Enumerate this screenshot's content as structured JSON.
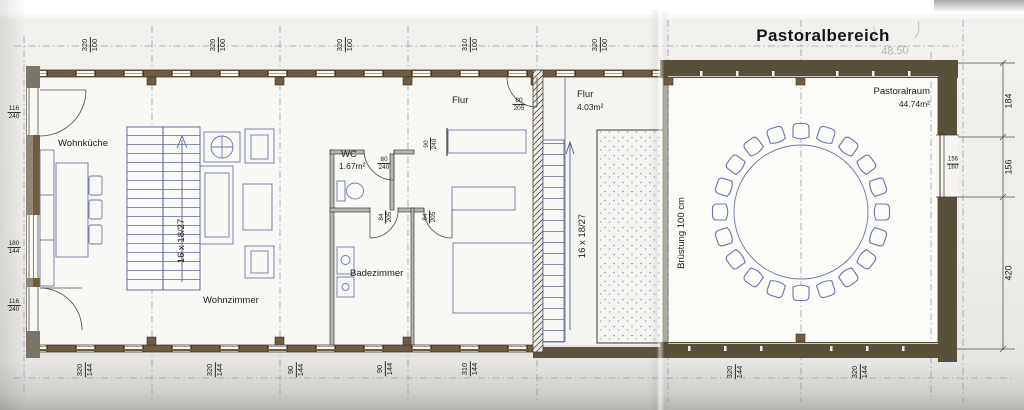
{
  "title": "Pastoralbereich",
  "faint_mark": "48.50",
  "rooms": {
    "wohnkueche": "Wohnküche",
    "wohnzimmer": "Wohnzimmer",
    "wc_name": "WC",
    "wc_area": "1.67m²",
    "badezimmer": "Badezimmer",
    "flur_small": "Flur",
    "flur_main": "Flur",
    "flur_main_area": "4.03m²",
    "pastoralraum_name": "Pastoralraum",
    "pastoralraum_area": "44.74m²"
  },
  "annotations": {
    "stair_left": "16 x 18/27",
    "stair_right": "16 x 18/27",
    "parapet": "Brüstung 100 cm"
  },
  "openings": {
    "wc_door": {
      "num": "80",
      "den": "240"
    },
    "flur_door": {
      "num": "80",
      "den": "205"
    },
    "bad_door": {
      "num": "84",
      "den": "205"
    },
    "room_door": {
      "num": "84",
      "den": "205"
    },
    "mid_window": {
      "num": "90",
      "den": "240"
    },
    "right_window": {
      "num": "156",
      "den": "160"
    }
  },
  "dims_top": [
    {
      "num": "320",
      "den": "100"
    },
    {
      "num": "320",
      "den": "100"
    },
    {
      "num": "320",
      "den": "100"
    },
    {
      "num": "310",
      "den": "100"
    },
    {
      "num": "320",
      "den": "100"
    }
  ],
  "dims_bottom": [
    {
      "num": "320",
      "den": "144"
    },
    {
      "num": "320",
      "den": "144"
    },
    {
      "num": "90",
      "den": "144"
    },
    {
      "num": "90",
      "den": "144"
    },
    {
      "num": "310",
      "den": "144"
    },
    {
      "num": "320",
      "den": "144"
    },
    {
      "num": "320",
      "den": "144"
    }
  ],
  "dims_left": [
    {
      "num": "116",
      "den": "240"
    },
    {
      "num": "180",
      "den": "144"
    },
    {
      "num": "116",
      "den": "240"
    }
  ],
  "dims_right": [
    "184",
    "156",
    "420"
  ],
  "colors": {
    "wall_dark": "#57503b",
    "wall_brown": "#6e5d42",
    "line_blue": "#6d77a3",
    "grid_blue": "#8693bb",
    "paper": "#efeeea"
  }
}
